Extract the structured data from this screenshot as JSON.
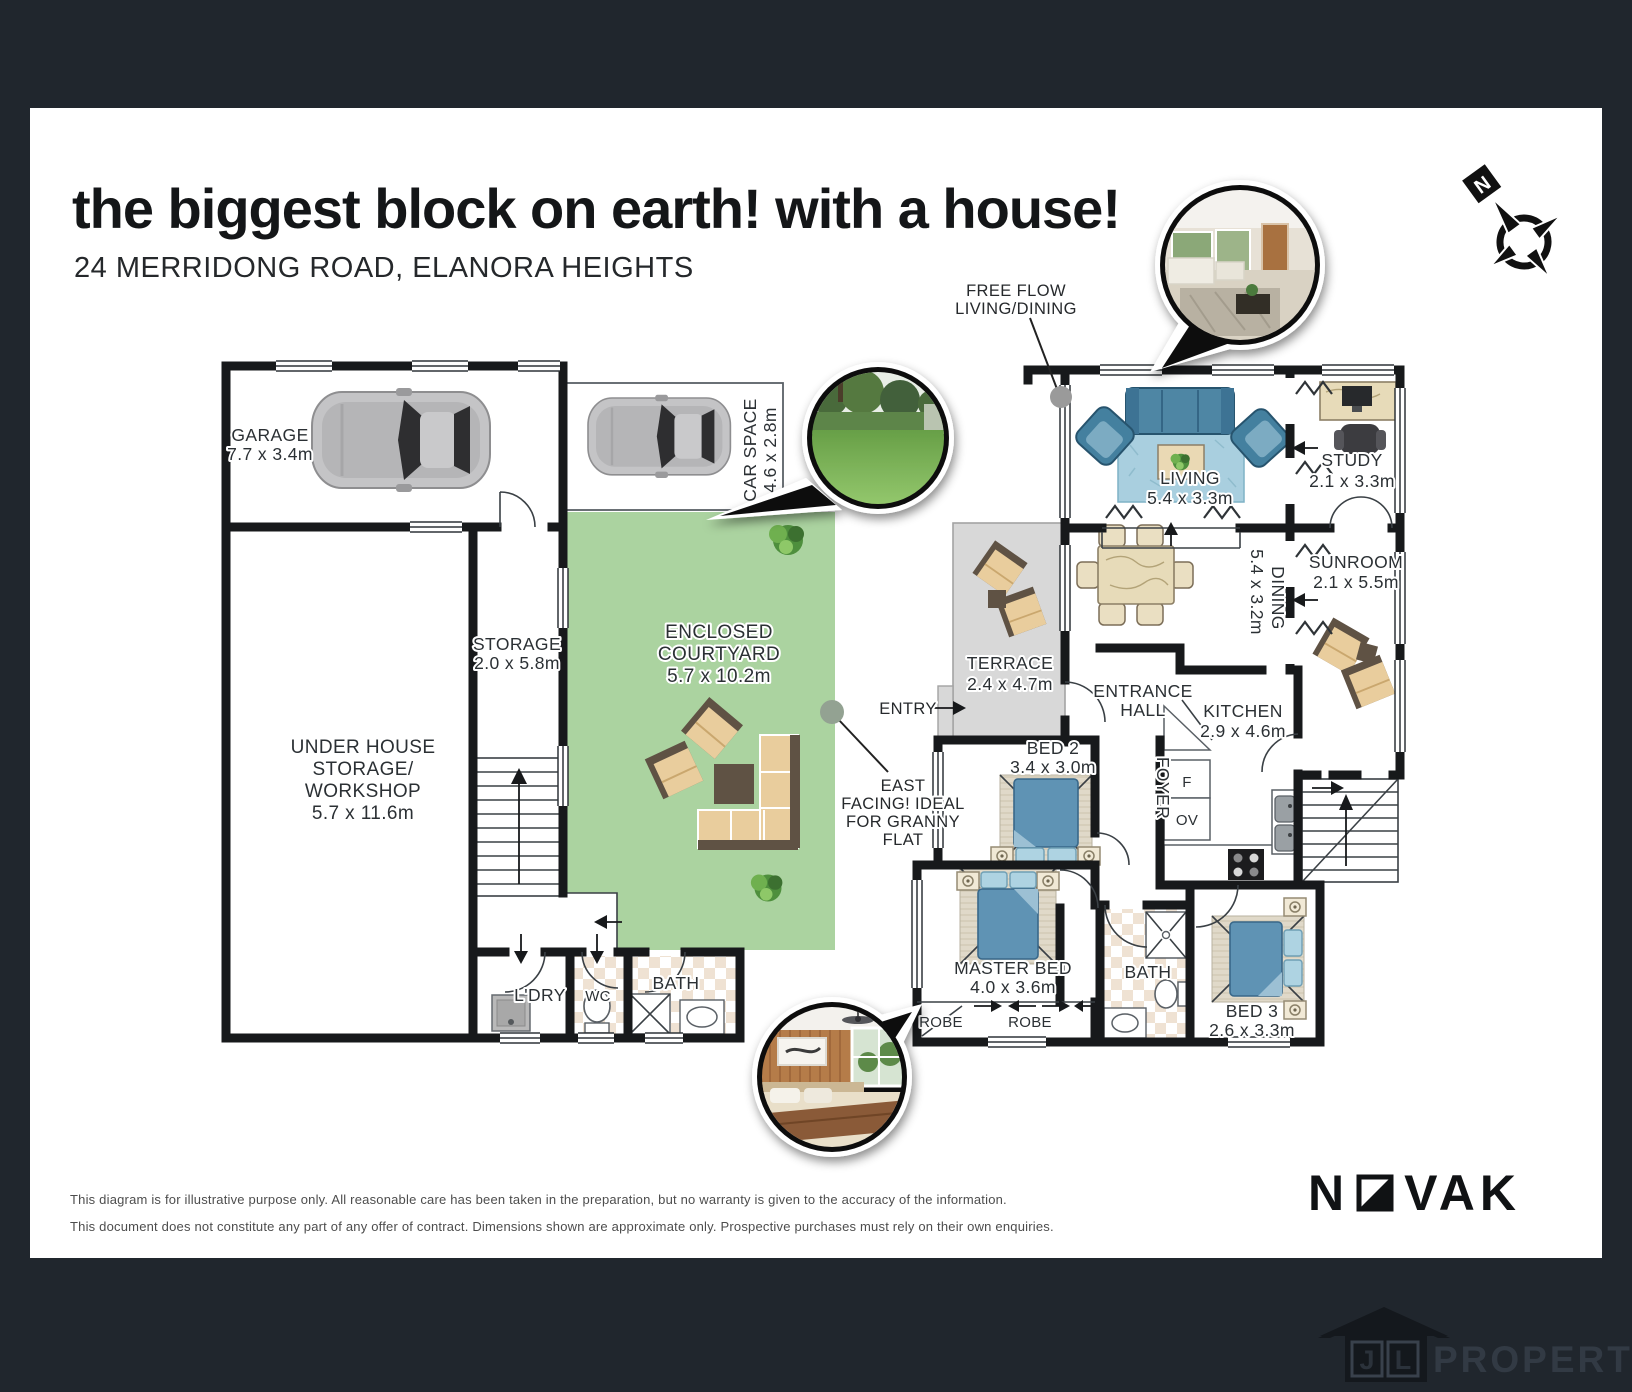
{
  "header": {
    "title": "the biggest block on earth! with a house!",
    "address": "24 MERRIDONG ROAD, ELANORA HEIGHTS"
  },
  "compass": {
    "north": "N"
  },
  "annotations": {
    "free_flow": {
      "lines": [
        "FREE FLOW",
        "LIVING/DINING"
      ]
    },
    "east_facing": {
      "lines": [
        "EAST",
        "FACING! IDEAL",
        "FOR GRANNY",
        "FLAT"
      ]
    },
    "entry": "ENTRY"
  },
  "rooms": {
    "garage": {
      "lines": [
        "GARAGE",
        "7.7 x 3.4m"
      ]
    },
    "car_space": {
      "lines": [
        "CAR SPACE",
        "4.6 x 2.8m"
      ]
    },
    "storage": {
      "lines": [
        "STORAGE",
        "2.0 x 5.8m"
      ]
    },
    "under_house": {
      "lines": [
        "UNDER HOUSE",
        "STORAGE/",
        "WORKSHOP",
        "5.7 x 11.6m"
      ]
    },
    "courtyard": {
      "lines": [
        "ENCLOSED",
        "COURTYARD",
        "5.7 x 10.2m"
      ]
    },
    "laundry": {
      "label": "L'DRY"
    },
    "wc": {
      "label": "WC"
    },
    "bath_lower": {
      "label": "BATH"
    },
    "living": {
      "lines": [
        "LIVING",
        "5.4 x 3.3m"
      ]
    },
    "study": {
      "lines": [
        "STUDY",
        "2.1 x 3.3m"
      ]
    },
    "dining": {
      "lines": [
        "DINING",
        "5.4 x 3.2m"
      ]
    },
    "sunroom": {
      "lines": [
        "SUNROOM",
        "2.1 x 5.5m"
      ]
    },
    "terrace": {
      "lines": [
        "TERRACE",
        "2.4 x 4.7m"
      ]
    },
    "entrance_hall": {
      "lines": [
        "ENTRANCE",
        "HALL"
      ]
    },
    "kitchen": {
      "lines": [
        "KITCHEN",
        "2.9 x 4.6m"
      ]
    },
    "foyer": {
      "label": "FOYER"
    },
    "fridge": {
      "label": "F"
    },
    "oven": {
      "label": "OV"
    },
    "bed2": {
      "lines": [
        "BED 2",
        "3.4 x 3.0m"
      ]
    },
    "master_bed": {
      "lines": [
        "MASTER BED",
        "4.0 x 3.6m"
      ]
    },
    "bath": {
      "label": "BATH"
    },
    "bed3": {
      "lines": [
        "BED 3",
        "2.6 x 3.3m"
      ]
    },
    "robe_small": {
      "label": "ROBE"
    },
    "robe_large": {
      "label": "ROBE"
    }
  },
  "footer": {
    "disclaimer_line1": "This diagram is for illustrative purpose only. All reasonable care has been taken in the preparation, but no warranty is given to the accuracy of the information.",
    "disclaimer_line2": "This document does not constitute any part of any offer of contract. Dimensions shown are approximate only. Prospective purchases must rely on their own enquiries."
  },
  "brand": {
    "prefix": "N",
    "suffix": "VAK"
  },
  "watermark": {
    "letter1": "J",
    "letter2": "L",
    "text": "PROPERTY"
  },
  "colors": {
    "frame": "#20262d",
    "wall": "#17191b",
    "courtyard_green": "#abd3a0",
    "terrace_grey": "#d8d8d8",
    "furniture_blue": "#4e86a4",
    "timber_tan": "#e7dbb9",
    "outdoor_tan": "#e9cd9d",
    "photo_ring": "#111111"
  }
}
